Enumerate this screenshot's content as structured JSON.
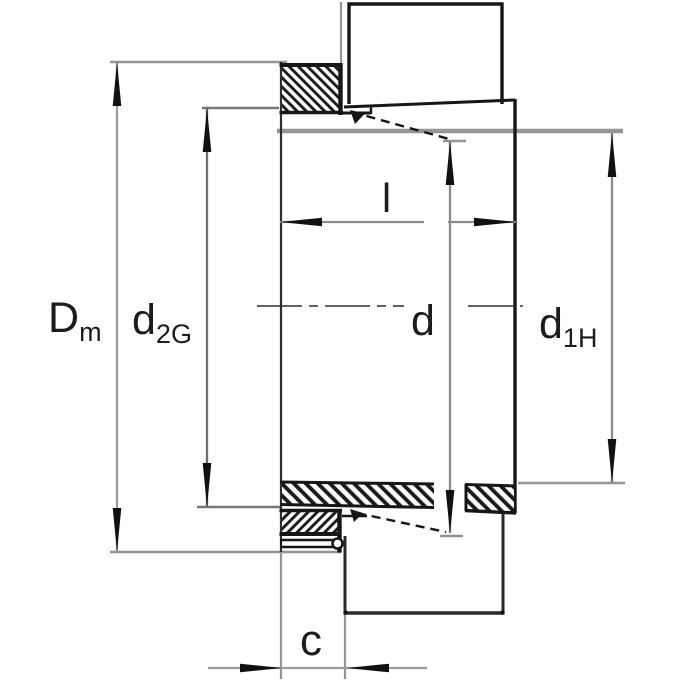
{
  "drawing": {
    "background": "#ffffff",
    "body_line_color": "#161616",
    "dimension_line_color": "#8f8f8f",
    "labels": {
      "dm": {
        "main": "D",
        "sub": "m"
      },
      "d2g": {
        "main": "d",
        "sub": "2G"
      },
      "l": {
        "main": "l"
      },
      "d": {
        "main": "d"
      },
      "d1h": {
        "main": "d",
        "sub": "1H"
      },
      "c": {
        "main": "c"
      }
    }
  }
}
